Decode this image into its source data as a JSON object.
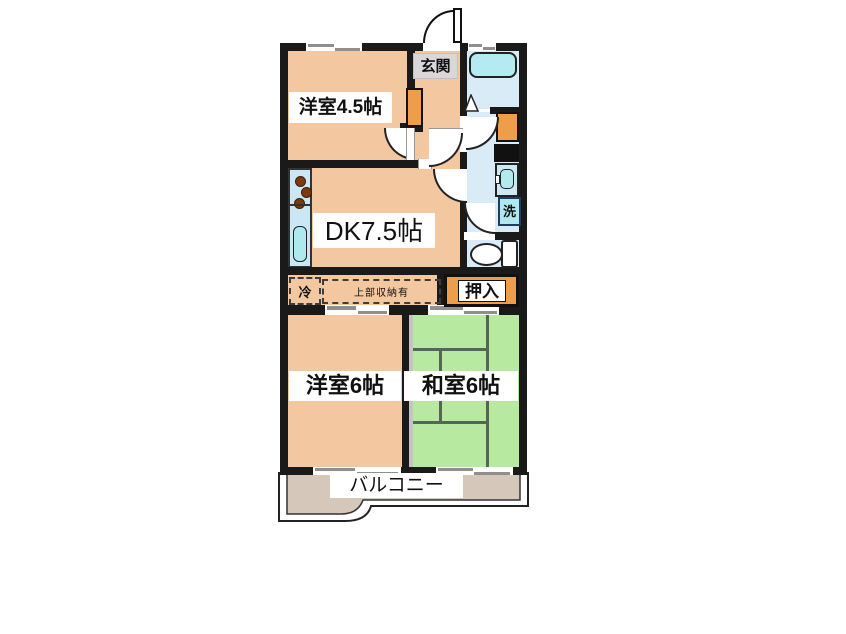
{
  "rooms": {
    "western45": {
      "label": "洋室4.5帖"
    },
    "dk": {
      "label": "DK7.5帖"
    },
    "western6": {
      "label": "洋室6帖"
    },
    "japanese6": {
      "label": "和室6帖"
    }
  },
  "areas": {
    "entrance": {
      "label": "玄関"
    },
    "closet": {
      "label": "押入"
    },
    "balcony": {
      "label": "バルコニー"
    }
  },
  "annotations": {
    "refrigerator": {
      "label": "冷"
    },
    "upper_storage": {
      "label": "上部収納有"
    },
    "washing_machine": {
      "label": "洗"
    }
  },
  "colors": {
    "wall": "#1a1a1a",
    "room_peach": "#f3c7a0",
    "tatami_green": "#b7e9a0",
    "wet_area_blue": "#d8ebf7",
    "fixture_cyan": "#b4ebf2",
    "storage_orange": "#ee9d4b",
    "balcony_tan": "#d5c8ba",
    "entrance_label_gray": "#d8d8d8"
  }
}
